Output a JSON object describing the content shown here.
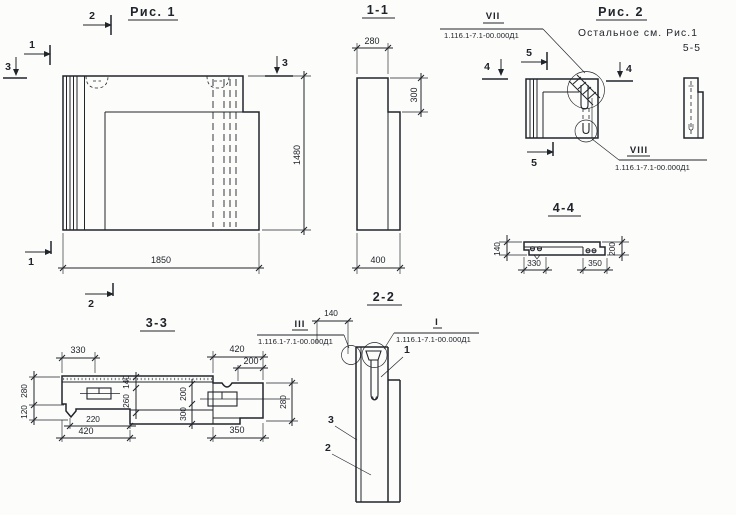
{
  "theme": {
    "ink": "#20242b",
    "paper": "#fcfcfa"
  },
  "fig1": {
    "title": "Рис. 1",
    "cut_2_top": "2",
    "cut_1_top": "1",
    "cut_3_left": "3",
    "cut_3_right": "3",
    "cut_1_bottom": "1",
    "cut_2_bottom": "2",
    "dim_width": "1850",
    "dim_height": "1480"
  },
  "sec11": {
    "title": "1-1",
    "dim_top": "280",
    "dim_step": "300",
    "dim_bottom": "400"
  },
  "fig2": {
    "title": "Рис. 2",
    "note_line1": "Остальное см. Рис.1",
    "note_line2": "5-5",
    "cut_4_left": "4",
    "cut_4_right": "4",
    "cut_5_top": "5",
    "cut_5_bottom": "5",
    "detail_vii": {
      "label": "VII",
      "doc": "1.116.1-7.1-00.000Д1"
    },
    "detail_viii": {
      "label": "VIII",
      "doc": "1.116.1-7.1-00.000Д1"
    }
  },
  "sec44": {
    "title": "4-4",
    "dim_height_left": "140",
    "dim_height_right": "200",
    "dim_bottom_left": "330",
    "dim_bottom_right": "350"
  },
  "sec33": {
    "title": "3-3",
    "dim_top_left": "330",
    "dim_top_right": "420",
    "dim_top_right_inner": "200",
    "dim_left_upper": "280",
    "dim_left_lower": "120",
    "dim_mid_upper": "140",
    "dim_mid_lower": "260",
    "dim_mid2_upper": "200",
    "dim_mid2_lower": "300",
    "dim_right": "280",
    "dim_bottom_inner": "220",
    "dim_bottom_left": "420",
    "dim_bottom_right": "350"
  },
  "sec22": {
    "title": "2-2",
    "dim_top": "140",
    "detail_iii": {
      "label": "III",
      "doc": "1.116.1-7.1-00.000Д1"
    },
    "detail_i": {
      "label": "I",
      "doc": "1.116.1-7.1-00.000Д1"
    },
    "part_1": "1",
    "part_2": "2",
    "part_3": "3"
  }
}
